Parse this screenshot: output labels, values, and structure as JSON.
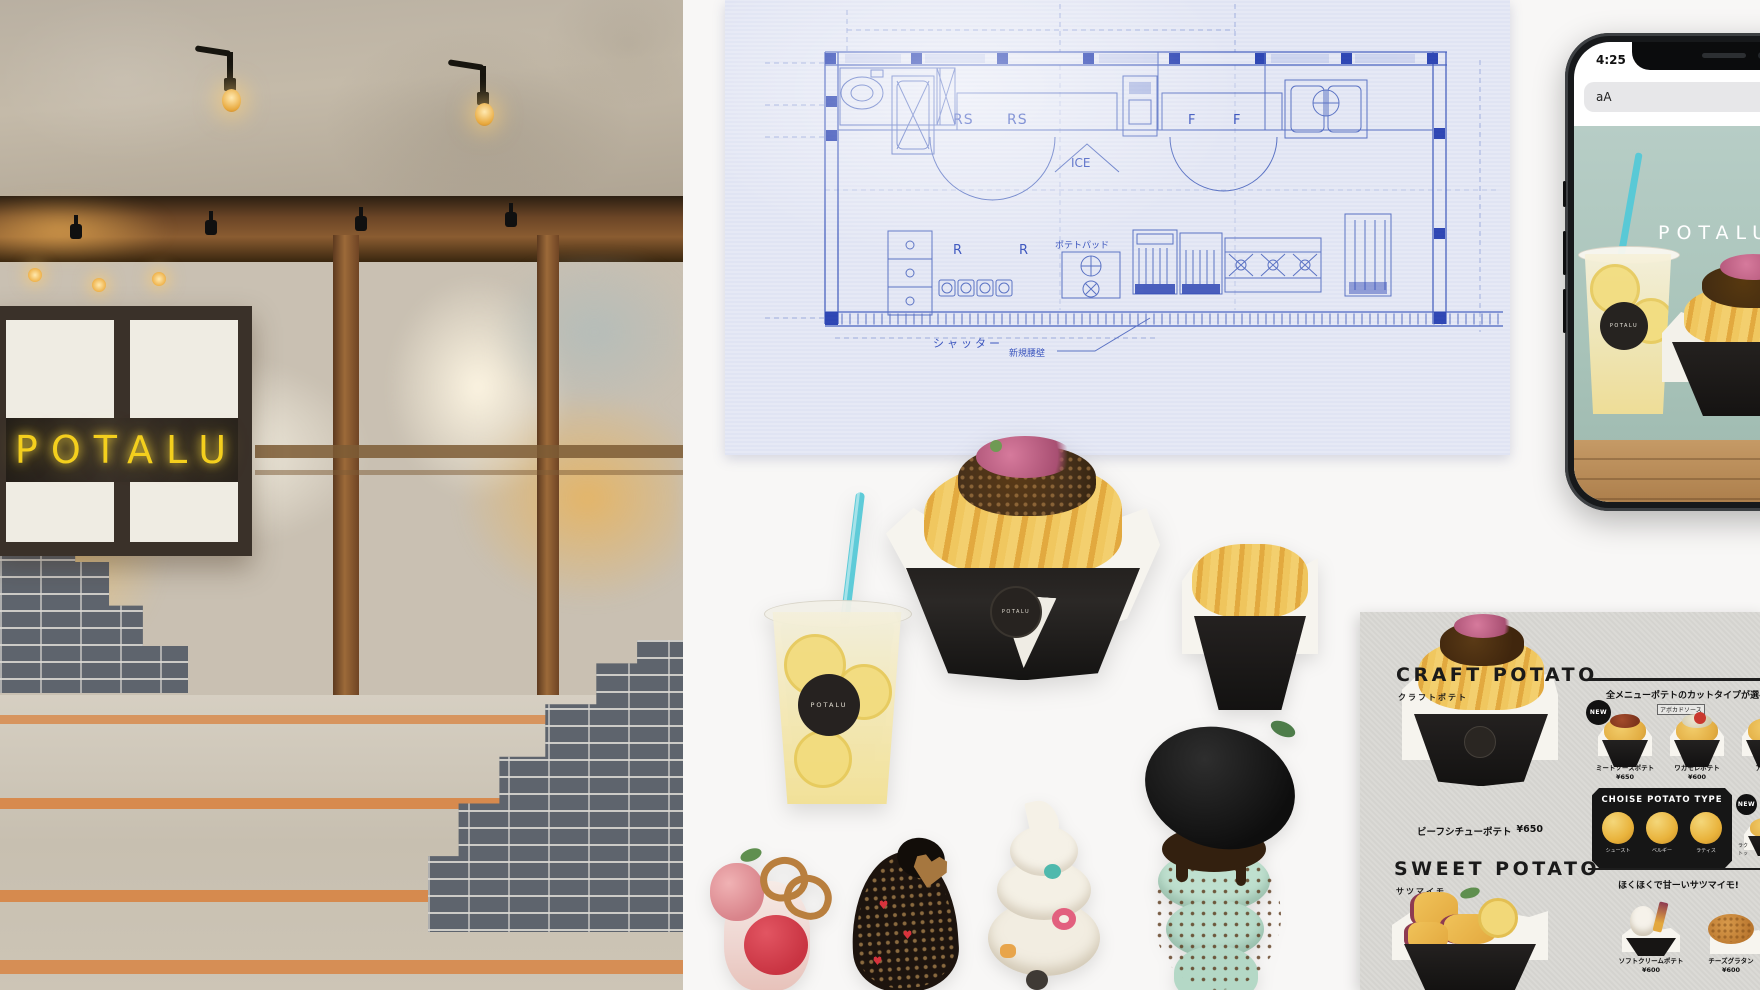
{
  "storefront": {
    "sign_text": "POTALU"
  },
  "blueprint": {
    "labels": {
      "rs1": "RS",
      "rs2": "RS",
      "ice": "ICE",
      "f1": "F",
      "f2": "F",
      "r1": "R",
      "r2": "R",
      "potato_pad": "ポテトパッド",
      "shutter": "シャッター",
      "new_low_wall": "新規腰壁"
    }
  },
  "phone": {
    "status_time": "4:25",
    "reader_button": "aA",
    "hero_title": "POTALU",
    "cup_logo": "POTALU"
  },
  "products": {
    "lemonade_logo": "POTALU",
    "fries_logo": "POTALU"
  },
  "menu": {
    "craft": {
      "heading": "CRAFT POTATO",
      "sub": "クラフトポテト",
      "note": "全メニューポテトのカットタイプが選べる!"
    },
    "new_badge": "NEW",
    "row1": [
      {
        "name": "ミートソースポテト",
        "price": "¥650"
      },
      {
        "name": "ワカモレポテト",
        "price": "¥600"
      },
      {
        "name": "アラ",
        "price": ""
      }
    ],
    "tag_item2": "アボカドソース",
    "choise": {
      "title": "CHOISE POTATO TYPE",
      "types": [
        "シュースト",
        "ベルギー",
        "ラティス"
      ]
    },
    "side_item": {
      "line1": "ラク",
      "line2": "トッ"
    },
    "beef": {
      "name": "ビーフシチューポテト",
      "price": "¥650"
    },
    "sweet": {
      "heading": "SWEET POTATO",
      "sub": "サツマイモ",
      "note": "ほくほくで甘ーいサツマイモ!",
      "items": [
        {
          "name": "ソフトクリームポテト",
          "price": "¥600"
        },
        {
          "name": "チーズグラタン",
          "price": "¥600"
        }
      ]
    }
  },
  "colors": {
    "neon_yellow": "#f4cf1d",
    "blueprint_line": "#4a63c0",
    "blueprint_paper": "#e6e9f5",
    "straw_teal": "#5ecbd8",
    "card_gray": "#d8d7d3",
    "brand_black": "#161616"
  }
}
